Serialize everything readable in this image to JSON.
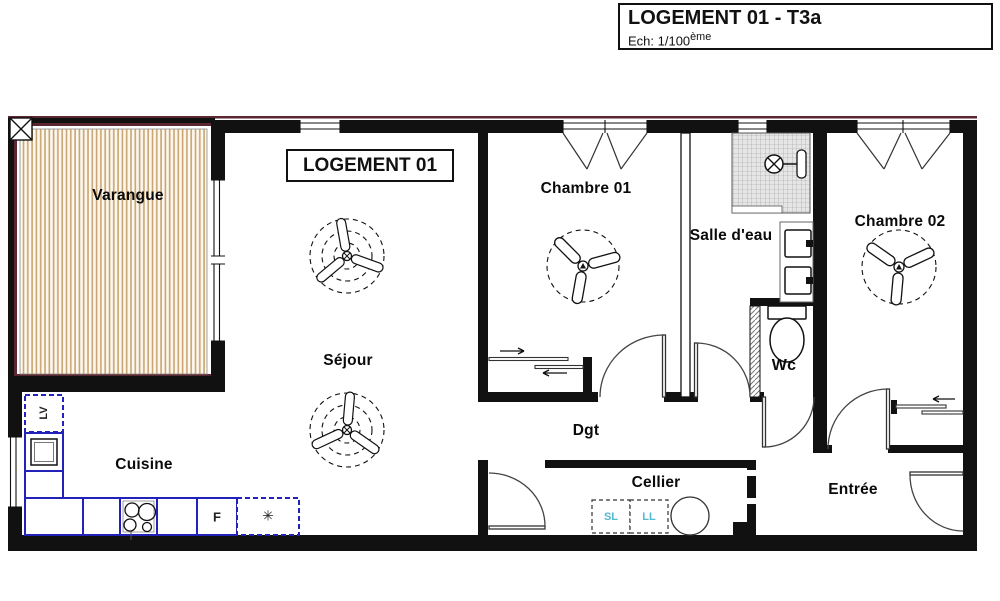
{
  "title_block": {
    "title": "LOGEMENT 01 - T3a",
    "scale_prefix": "Ech: 1/100",
    "scale_sup": "ème"
  },
  "plan_label": "LOGEMENT 01",
  "rooms": {
    "varangue": {
      "label": "Varangue"
    },
    "sejour": {
      "label": "Séjour"
    },
    "cuisine": {
      "label": "Cuisine"
    },
    "chambre01": {
      "label": "Chambre 01"
    },
    "salle_eau": {
      "label": "Salle d'eau"
    },
    "chambre02": {
      "label": "Chambre 02"
    },
    "wc": {
      "label": "Wc"
    },
    "dgt": {
      "label": "Dgt"
    },
    "cellier": {
      "label": "Cellier"
    },
    "entree": {
      "label": "Entrée"
    }
  },
  "appliances": {
    "dishwasher": "LV",
    "fridge": "F",
    "freezer": "✳",
    "dryer": "SL",
    "washer": "LL"
  },
  "colors": {
    "wall": "#111111",
    "accent_maroon": "#5a2630",
    "hatch_tan": "#c9a470",
    "kitchen_blue": "#2222bb",
    "appliance_cyan": "#55b9cf",
    "shower_gray": "#e3e3e3"
  }
}
